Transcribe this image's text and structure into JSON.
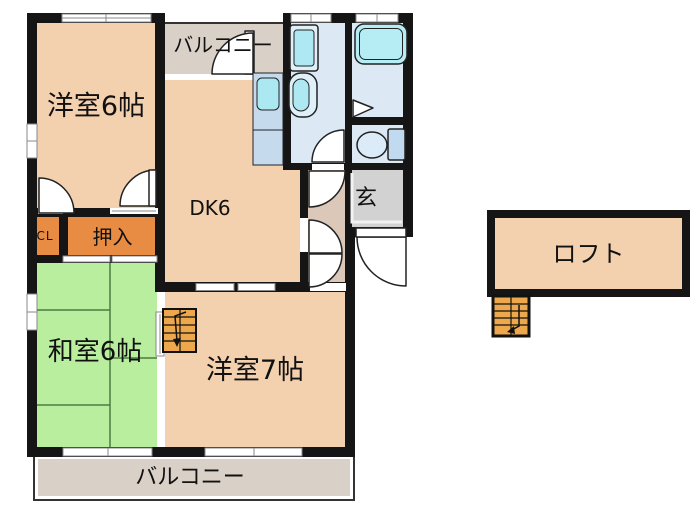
{
  "floorplan": {
    "rooms": {
      "western6": {
        "label": "洋室6帖"
      },
      "balcony_top": {
        "label": "バルコニー"
      },
      "dk": {
        "label": "DK6"
      },
      "genkan": {
        "label": "玄"
      },
      "cl": {
        "label": "CL"
      },
      "oshiire": {
        "label": "押入"
      },
      "japanese6": {
        "label": "和室6帖"
      },
      "western7": {
        "label": "洋室7帖"
      },
      "balcony_bottom": {
        "label": "バルコニー"
      },
      "loft": {
        "label": "ロフト"
      }
    },
    "colors": {
      "wall": "#151515",
      "room_peach": "#f3d0ae",
      "closet_orange": "#e78c42",
      "stairs_orange": "#eda84d",
      "tatami_green": "#b9ee9f",
      "balcony_gray": "#d9d0c8",
      "genkan_gray": "#d2d2d2",
      "hall_tan": "#dbc8b8",
      "wet_floor_blue": "#dce9f5",
      "fixture_cyan": "#aeebf2",
      "fixture_blue": "#c6daee"
    }
  }
}
